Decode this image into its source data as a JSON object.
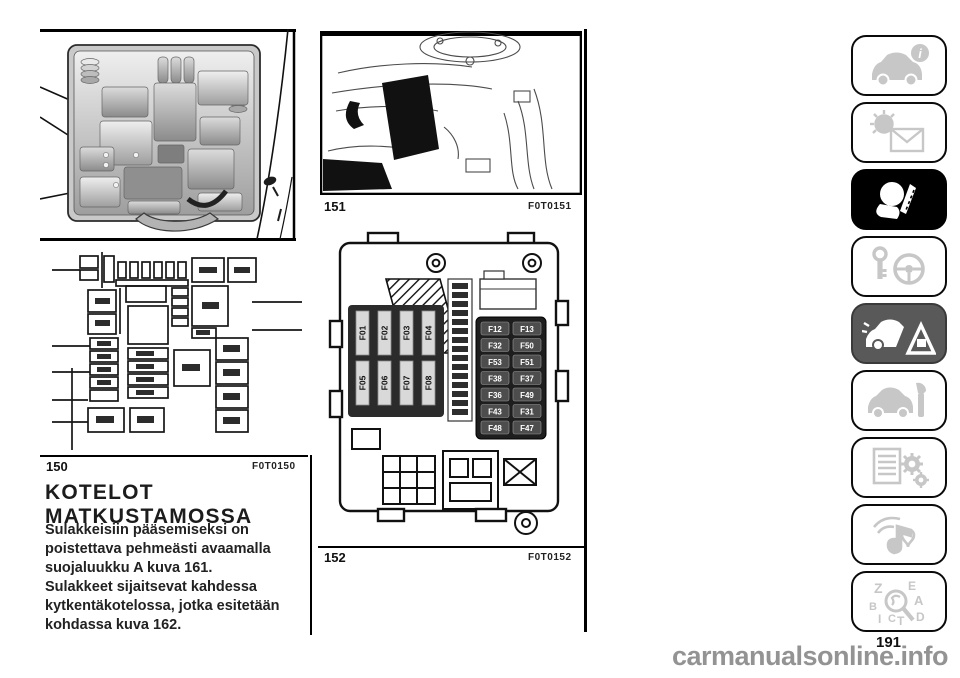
{
  "figures": {
    "f150": {
      "num": "150",
      "code": "F0T0150"
    },
    "f151": {
      "num": "151",
      "code": "F0T0151"
    },
    "f152": {
      "num": "152",
      "code": "F0T0152"
    }
  },
  "section": {
    "title_line1": "KOTELOT",
    "title_line2": "MATKUSTAMOSSA",
    "lines": [
      "Sulakkeisiin pääsemiseksi on",
      "poistettava pehmeästi avaamalla",
      "suojaluukku A kuva 161.",
      "Sulakkeet sijaitsevat kahdessa",
      "kytkentäkotelossa, jotka esitetään",
      "kohdassa kuva 162."
    ]
  },
  "fuses": {
    "left": [
      "F01",
      "F02",
      "F03",
      "F04",
      "F05",
      "F06",
      "F07",
      "F08"
    ],
    "right": [
      [
        "F12",
        "F13"
      ],
      [
        "F32",
        "F50"
      ],
      [
        "F53",
        "F51"
      ],
      [
        "F38",
        "F37"
      ],
      [
        "F36",
        "F49"
      ],
      [
        "F43",
        "F31"
      ],
      [
        "F48",
        "F47"
      ]
    ]
  },
  "sidebar": {
    "info_badge": "i",
    "index_letters": [
      "Z",
      "E",
      "B",
      "A",
      "C",
      "T",
      "D",
      "I"
    ],
    "icons": [
      "car-info-icon",
      "lights-messages-icon",
      "safety-airbag-icon",
      "ignition-steering-icon",
      "emergency-icon",
      "service-wrench-icon",
      "technical-data-icon",
      "multimedia-icon",
      "alphabetical-index-icon"
    ]
  },
  "footer": {
    "page_number": "191",
    "watermark": "carmanualsonline.info"
  }
}
